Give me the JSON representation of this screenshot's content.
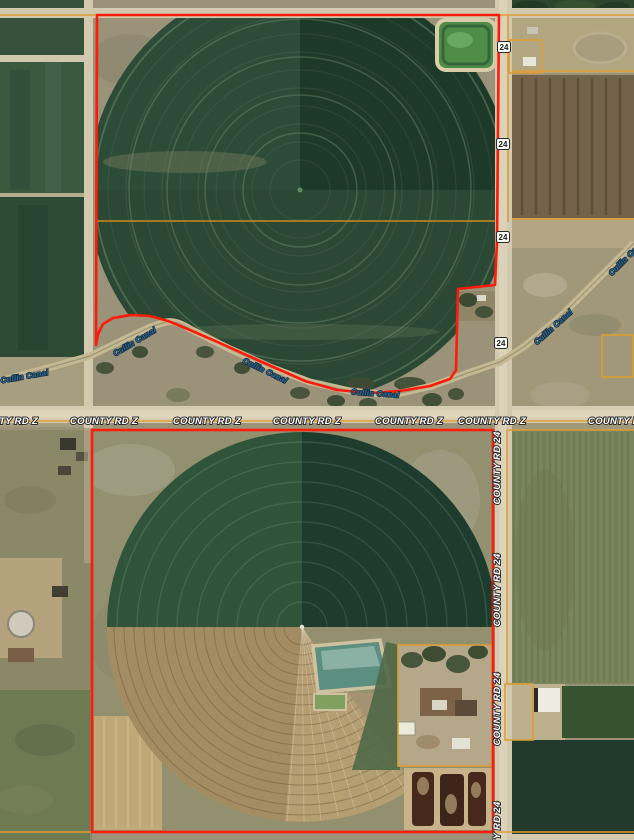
{
  "map": {
    "road_labels": {
      "county_road_z": "COUNTY RD Z",
      "county_road_24": "COUNTY RD 24"
    },
    "canal_label": "Cullin Canal",
    "route_marker": {
      "value": "24"
    },
    "colors": {
      "parcel_boundary": "#ff1a0a",
      "section_line": "#dd9d35",
      "quarter_section_line": "#cc8a1a",
      "road_label_text": "#ffffff",
      "canal_label_text": "#2f6b94",
      "route_marker_background": "#fdfdf8",
      "route_marker_text": "#1a1a1a"
    }
  }
}
